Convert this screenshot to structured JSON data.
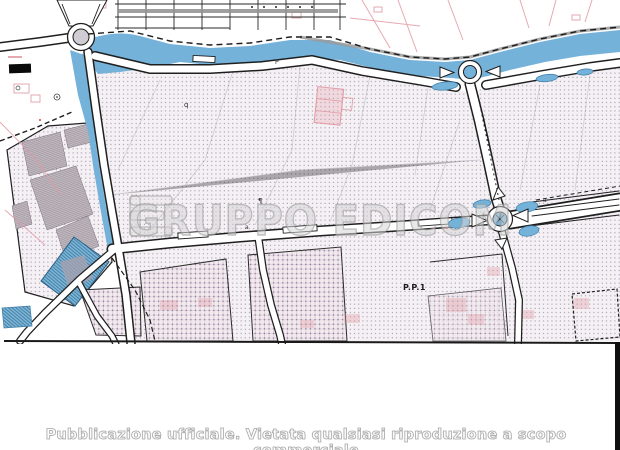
{
  "map": {
    "kind": "urban-planning-cadastral-scan",
    "zone_label": "P.P.1",
    "glyph_marks": [
      "q",
      "¶",
      "P",
      "a",
      "a"
    ],
    "colors": {
      "water": "#74b2da",
      "water_edge": "#3f7da8",
      "hatch_bg": "#f5f0f4",
      "hatch_dot": "#7e7490",
      "dense_line": "#a87d9a",
      "building_gray": "#bfb6bd",
      "pink": "#e29aa4",
      "ink": "#1f1f1f",
      "road_fill": "#ffffff",
      "grid_gray": "#8f8f8f",
      "scan_edge_black": "#0f0f0f"
    }
  },
  "watermark": {
    "logo": "edicom-logo",
    "text": "GRUPPO EDICOM"
  },
  "footer": {
    "caption": "Pubblicazione ufficiale. Vietata qualsiasi riproduzione a scopo commerciale"
  }
}
